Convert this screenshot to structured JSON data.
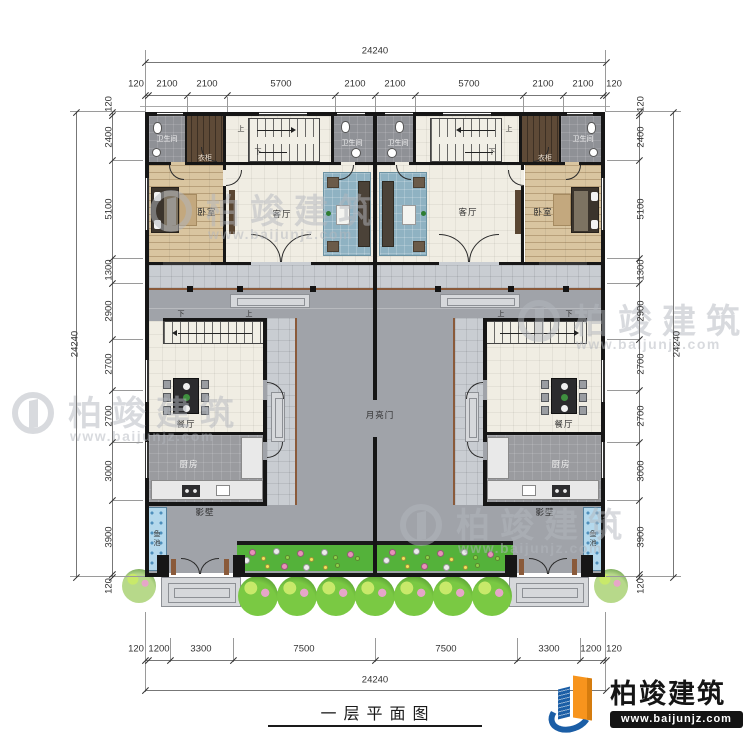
{
  "title": {
    "text": "一层平面图"
  },
  "brand": {
    "name": "柏竣建筑",
    "url": "www.baijunjz.com"
  },
  "watermark": {
    "name": "柏竣建筑",
    "url": "www.baijunjz.com"
  },
  "dimensions": {
    "top": {
      "total": "24240",
      "segments": [
        "120",
        "2100",
        "2100",
        "5700",
        "2100",
        "2100",
        "5700",
        "2100",
        "2100",
        "120"
      ]
    },
    "bottom": {
      "total": "24240",
      "segments": [
        "120",
        "1200",
        "3300",
        "7500",
        "7500",
        "3300",
        "1200",
        "120"
      ]
    },
    "left": {
      "total": "24240",
      "segments": [
        "120",
        "2400",
        "5100",
        "1300",
        "2900",
        "2700",
        "2700",
        "3000",
        "3900",
        "120"
      ]
    },
    "right": {
      "total": "24240",
      "segments": [
        "120",
        "2400",
        "5100",
        "1300",
        "2900",
        "2700",
        "2700",
        "3000",
        "3900",
        "120"
      ]
    }
  },
  "rooms": {
    "bathroom": "卫生间",
    "closet": "衣柜",
    "bedroom": "卧室",
    "living": "客厅",
    "dining": "餐厅",
    "kitchen": "厨房",
    "screen_wall": "影壁",
    "fish_pond": "鱼池",
    "moon_gate": "月亮门"
  },
  "stairs": {
    "up": "上",
    "down": "下"
  },
  "colors": {
    "wall": "#161616",
    "courtyard": "#a0a3a9",
    "veranda_tile": "#c9cdd2",
    "interior_tile": "#f0ede3",
    "wood_floor": "#d9c5a0",
    "bath_tile": "#8f9196",
    "garden_green": "#54b23a",
    "pond_blue": "#b4d8ec",
    "railing_brown": "#8a5a3a",
    "brand_blue": "#1b5ea6",
    "brand_orange": "#f7941d",
    "watermark_gray": "#b3b7be"
  }
}
